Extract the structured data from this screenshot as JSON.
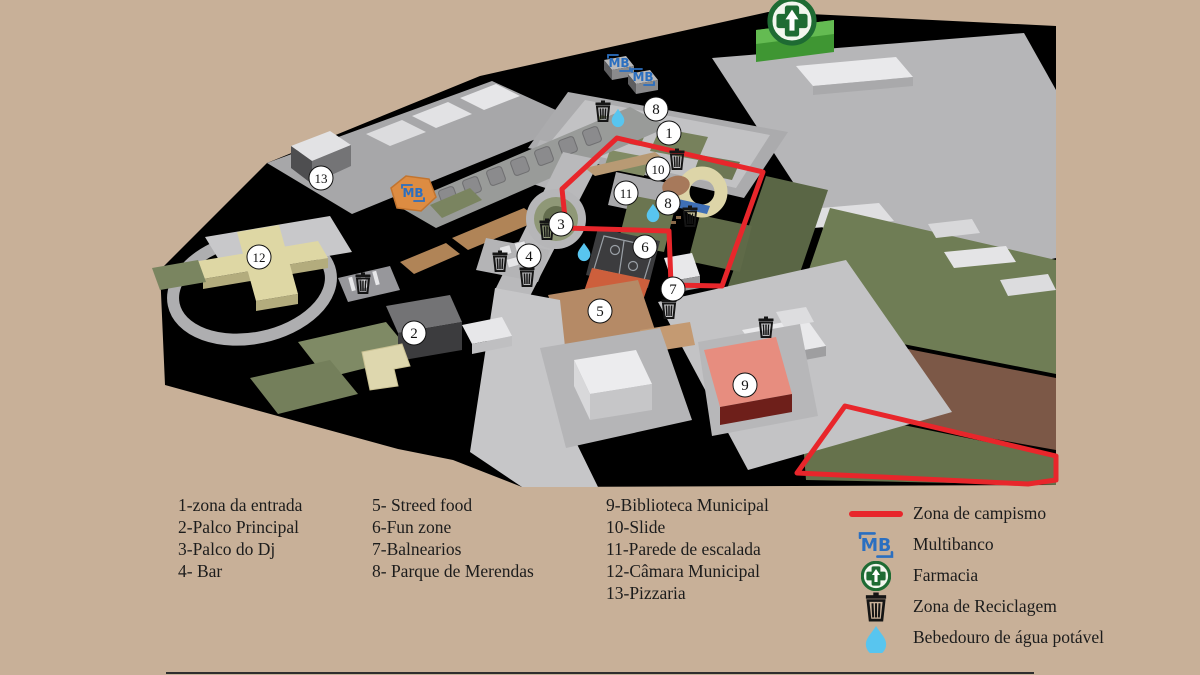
{
  "title": "Festival site map",
  "colors": {
    "background": "#c8b098",
    "map_black": "#000000",
    "camping_red": "#e8262b",
    "mb_blue": "#2b6fc0",
    "pharmacy_green": "#1e6b33",
    "drop_blue": "#58c5ef",
    "legend_text": "#1c1c1c"
  },
  "legend": {
    "columns": [
      {
        "items": [
          "1-zona da entrada",
          "2-Palco Principal",
          "3-Palco do Dj",
          "4- Bar"
        ]
      },
      {
        "items": [
          "5- Streed food",
          "6-Fun zone",
          "7-Balnearios",
          "8- Parque de Merendas"
        ]
      },
      {
        "items": [
          "9-Biblioteca Municipal",
          "10-Slide",
          "11-Parede de escalada",
          "12-Câmara Municipal",
          "13-Pizzaria"
        ]
      }
    ],
    "symbols": [
      {
        "icon": "redline",
        "label": "Zona de campismo"
      },
      {
        "icon": "mb",
        "label": "Multibanco"
      },
      {
        "icon": "pharmacy",
        "label": "Farmacia"
      },
      {
        "icon": "trash",
        "label": "Zona de Reciclagem"
      },
      {
        "icon": "drop",
        "label": "Bebedouro de água potável"
      }
    ]
  },
  "map": {
    "markers": [
      {
        "n": "1",
        "x": 669,
        "y": 133
      },
      {
        "n": "2",
        "x": 414,
        "y": 333
      },
      {
        "n": "3",
        "x": 561,
        "y": 224
      },
      {
        "n": "4",
        "x": 529,
        "y": 256
      },
      {
        "n": "5",
        "x": 600,
        "y": 311
      },
      {
        "n": "6",
        "x": 645,
        "y": 247
      },
      {
        "n": "7",
        "x": 673,
        "y": 289
      },
      {
        "n": "8",
        "x": 656,
        "y": 109
      },
      {
        "n": "8",
        "x": 668,
        "y": 203
      },
      {
        "n": "9",
        "x": 745,
        "y": 385
      },
      {
        "n": "10",
        "x": 658,
        "y": 169
      },
      {
        "n": "11",
        "x": 626,
        "y": 193
      },
      {
        "n": "12",
        "x": 259,
        "y": 257
      },
      {
        "n": "13",
        "x": 321,
        "y": 178
      }
    ],
    "icons": {
      "mb": [
        [
          619,
          63
        ],
        [
          643,
          77
        ],
        [
          413,
          193
        ]
      ],
      "pharmacy": [
        [
          792,
          21
        ]
      ],
      "trash": [
        [
          603,
          112
        ],
        [
          677,
          160
        ],
        [
          690,
          217
        ],
        [
          547,
          230
        ],
        [
          500,
          262
        ],
        [
          527,
          277
        ],
        [
          363,
          284
        ],
        [
          669,
          309
        ],
        [
          766,
          328
        ]
      ],
      "drop": [
        [
          618,
          117
        ],
        [
          653,
          212
        ],
        [
          584,
          251
        ]
      ]
    },
    "red_zones": [
      "617,138 763,172 722,286 671,285 669,231 566,228 562,189",
      "845,406 1056,456 1056,480 1028,484 797,473"
    ]
  }
}
